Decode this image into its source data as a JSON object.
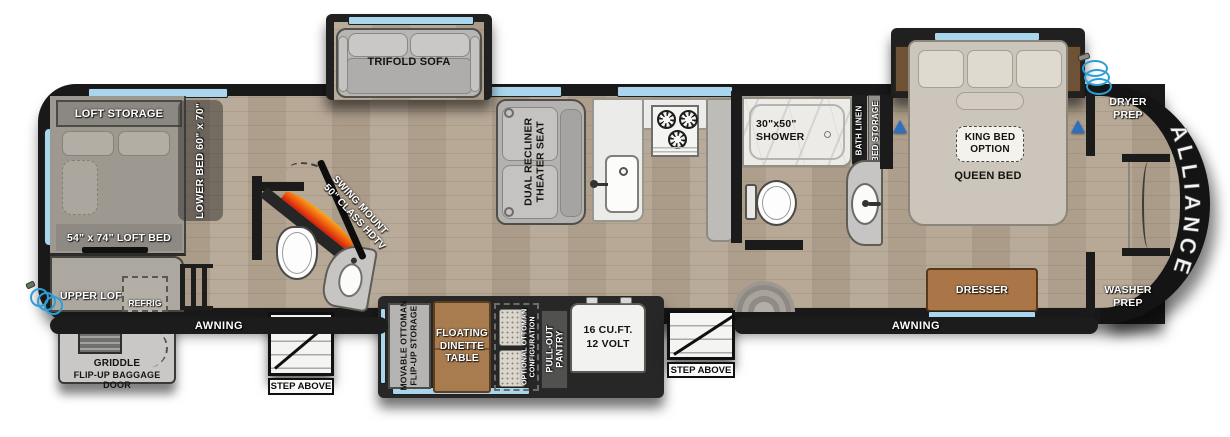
{
  "brand": "ALLIANCE",
  "colors": {
    "window_blue": "#a9d6ec",
    "hull_black": "#1a1a1a",
    "floor_wood": "#b5a693",
    "flame_orange": "#f8ab1e",
    "flame_red": "#cf1d10",
    "hose_blue": "#2d9fd8",
    "table_wood": "#a97c50",
    "dresser_wood": "#aa7648"
  },
  "rear": {
    "loft_storage": "LOFT STORAGE",
    "lower_bed": "LOWER BED 60\" x 70\"",
    "loft_bed": "54\" x 74\" LOFT BED",
    "upper_loft": "UPPER LOFT",
    "refrig": "REFRIG",
    "griddle_line1": "GRIDDLE",
    "griddle_line2": "FLIP-UP BAGGAGE DOOR"
  },
  "living": {
    "trifold_sofa": "TRIFOLD SOFA",
    "theater_line1": "DUAL RECLINER",
    "theater_line2": "THEATER SEAT",
    "tv_line1": "SWING MOUNT",
    "tv_line2": "50\" CLASS HDTV"
  },
  "kitchen": {
    "movable_line1": "MOVABLE OTTOMAN",
    "movable_line2": "FLIP-UP STORAGE",
    "dinette_line1": "FLOATING",
    "dinette_line2": "DINETTE",
    "dinette_line3": "TABLE",
    "optional_line1": "OPTIONAL OTTOMAN",
    "optional_line2": "CONFIGURATION",
    "pantry_line1": "PULL-OUT",
    "pantry_line2": "PANTRY",
    "fridge_line1": "16 CU.FT.",
    "fridge_line2": "12 VOLT"
  },
  "bath": {
    "shower_line1": "30\"x50\"",
    "shower_line2": "SHOWER",
    "bath_linen": "BATH LINEN",
    "bed_storage": "BED STORAGE"
  },
  "bedroom": {
    "king_line1": "KING BED",
    "king_line2": "OPTION",
    "queen_bed": "QUEEN BED",
    "dresser": "DRESSER",
    "dryer_line1": "DRYER",
    "dryer_line2": "PREP",
    "washer_line1": "WASHER",
    "washer_line2": "PREP"
  },
  "exterior": {
    "awning_left": "AWNING",
    "awning_right": "AWNING",
    "step_left": "STEP ABOVE",
    "step_right": "STEP ABOVE"
  }
}
